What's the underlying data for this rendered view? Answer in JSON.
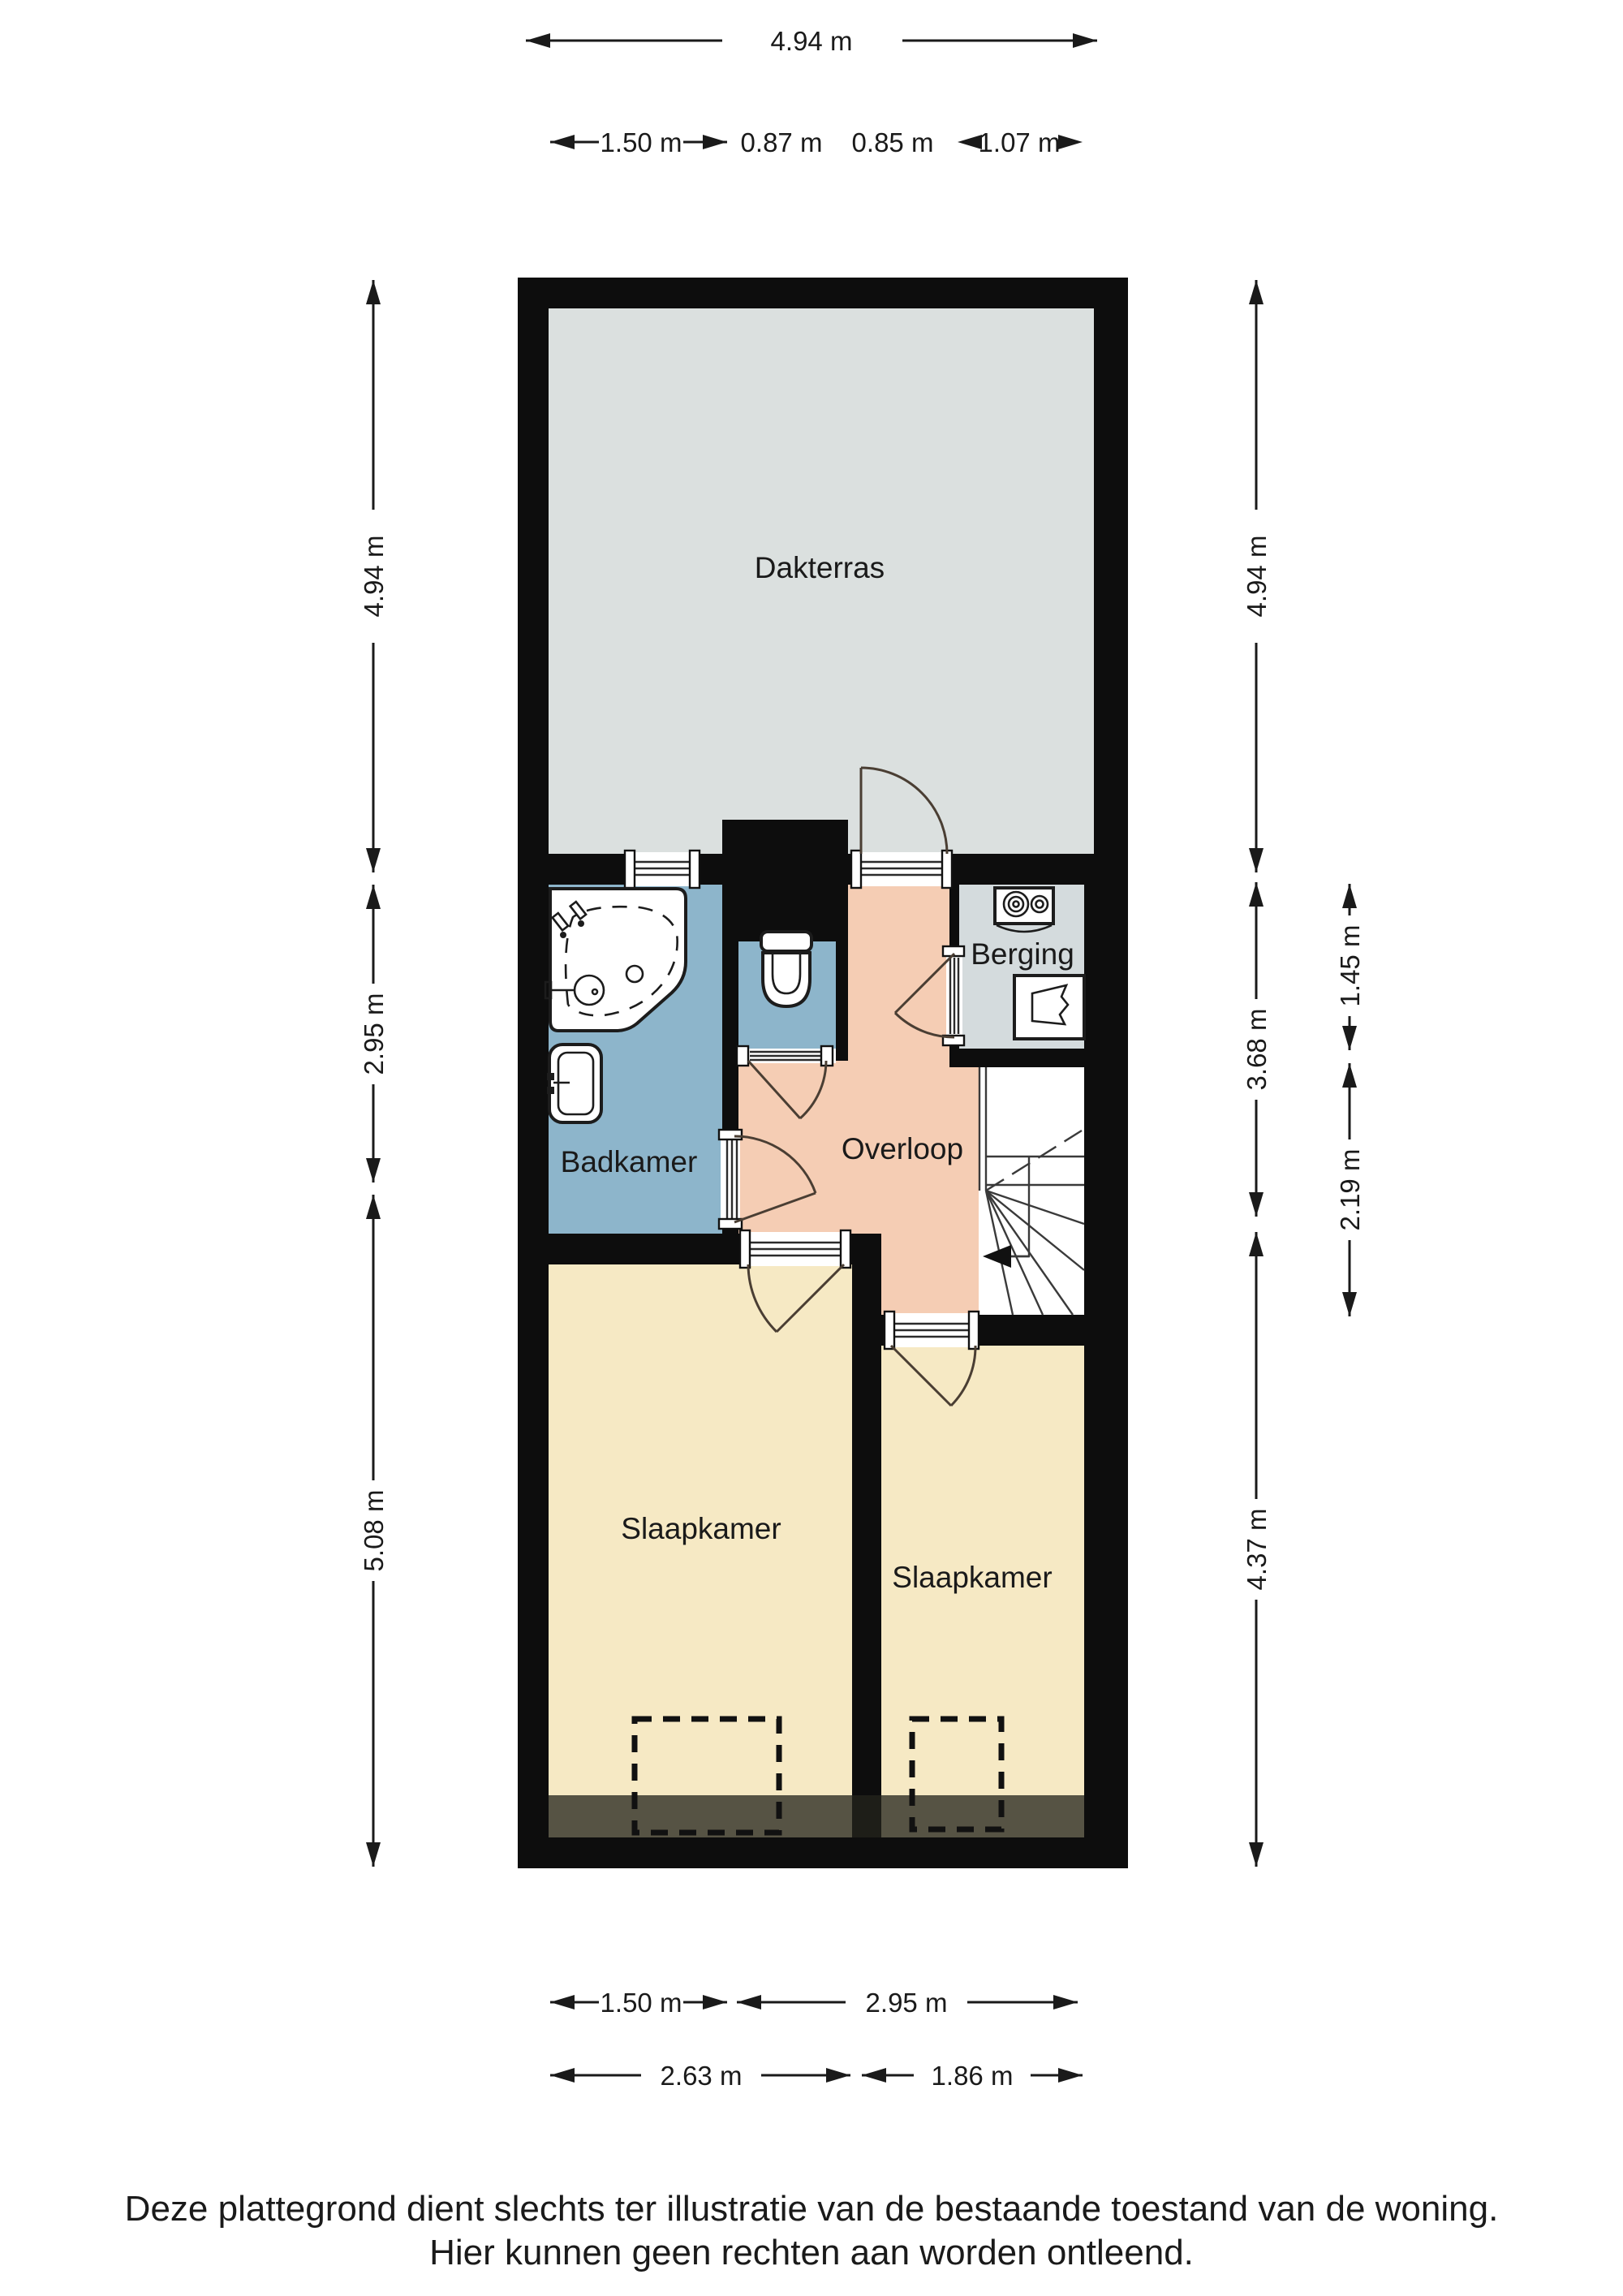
{
  "plan": {
    "rooms": {
      "dakterras": {
        "label": "Dakterras"
      },
      "badkamer": {
        "label": "Badkamer"
      },
      "overloop": {
        "label": "Overloop"
      },
      "berging": {
        "label": "Berging"
      },
      "slaapkamer_left": {
        "label": "Slaapkamer"
      },
      "slaapkamer_right": {
        "label": "Slaapkamer"
      }
    },
    "fixtures": [
      "bathtub",
      "sink",
      "toilet",
      "washing-machine",
      "boiler",
      "staircase",
      "door-swing",
      "window"
    ],
    "colors": {
      "wall": "#0d0d0d",
      "terrace": "#dbe0df",
      "bathroom": "#8db5cb",
      "landing": "#f5cdb4",
      "storage": "#d4dbdd",
      "bedroom": "#f6e9c4",
      "low_headroom": "rgba(36,35,28,0.76)"
    }
  },
  "dimensions": {
    "top_total": "4.94 m",
    "top_segments": [
      "1.50 m",
      "0.87 m",
      "0.85 m",
      "1.07 m"
    ],
    "left": [
      "4.94 m",
      "2.95 m",
      "5.08 m"
    ],
    "right_inner": [
      "4.94 m",
      "3.68 m",
      "4.37 m"
    ],
    "right_outer": [
      "1.45 m",
      "2.19 m"
    ],
    "bottom_row1": [
      "1.50 m",
      "2.95 m"
    ],
    "bottom_row2": [
      "2.63 m",
      "1.86 m"
    ]
  },
  "footer": {
    "line1": "Deze plattegrond dient slechts ter illustratie van de bestaande toestand van de woning.",
    "line2": "Hier kunnen geen rechten aan worden ontleend."
  }
}
